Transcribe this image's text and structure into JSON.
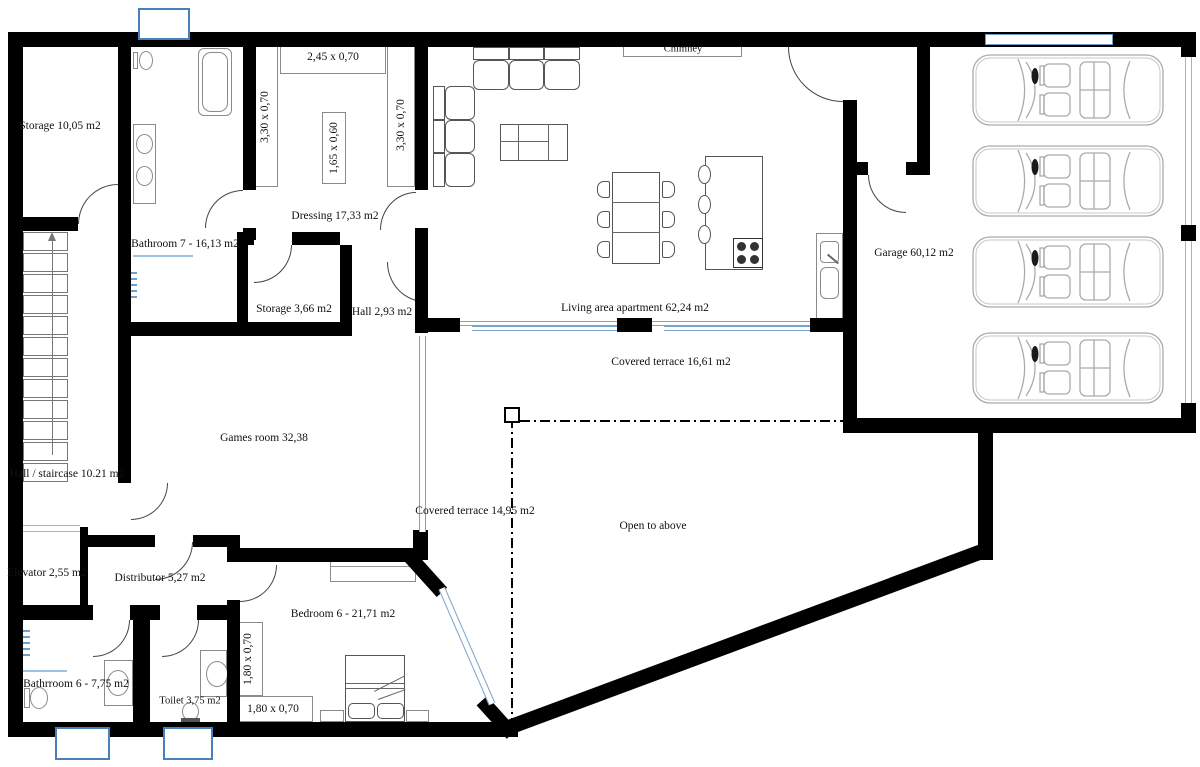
{
  "labels": {
    "storage_top": "Storage 10,05 m2",
    "bathroom7": "Bathroom 7 - 16,13 m2",
    "dressing": "Dressing 17,33 m2",
    "chimney": "Chimney",
    "living_area": "Living area apartment 62,24 m2",
    "garage": "Garage 60,12 m2",
    "storage_small": "Storage 3,66 m2",
    "hall_small": "Hall 2,93 m2",
    "covered_terrace_upper": "Covered terrace 16,61 m2",
    "games_room": "Games room 32,38",
    "hall_staircase": "Hall / staircase 10.21 m2",
    "covered_terrace_lower": "Covered terrace 14,95 m2",
    "open_to_above": "Open to above",
    "elevator": "Elevator 2,55 m2",
    "distributor": "Distributor 5,27 m2",
    "bedroom6": "Bedroom 6 - 21,71 m2",
    "bathroom6": "Bathrroom 6 -  7,75 m2",
    "toilet": "Toilet 3,75 m2"
  },
  "dimensions": {
    "wardrobe_top": "2,45 x 0,70",
    "wardrobe_left": "3,30 x 0,70",
    "wardrobe_right": "3,30 x 0,70",
    "island": "1,65 x 0,60",
    "bedroom_wardrobe_left": "1,80 x 0,70",
    "bedroom_wardrobe_bottom": "1,80 x 0,70"
  },
  "colors": {
    "wall": "#000000",
    "door_arc": "#444444",
    "glazing": "#7aa3cc",
    "lightwell_border": "#4a7fbe",
    "garage_door": "#c9af76",
    "furniture_outline": "#555555",
    "car_outline": "#ababab"
  }
}
